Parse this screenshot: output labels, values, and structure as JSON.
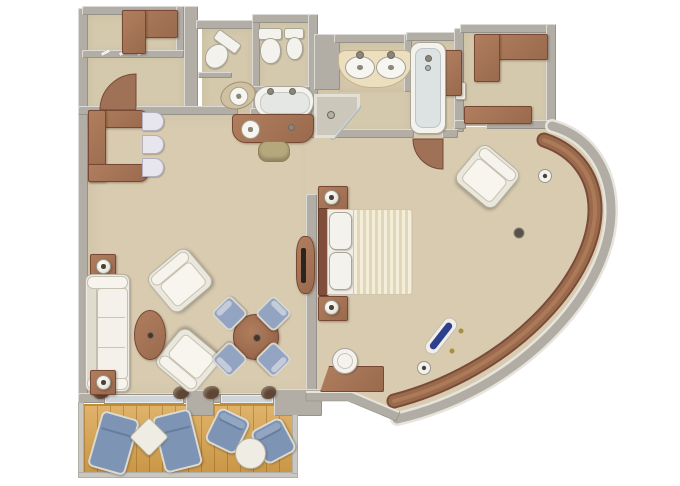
{
  "meta": {
    "kind": "3d-floorplan-rendering",
    "subject": "penthouse-suite-with-curved-veranda",
    "visible_text": []
  },
  "palette": {
    "background": "#ffffff",
    "wall": "#b2aea6",
    "wall_light": "#e7e4dd",
    "wall_dark": "#8f8b83",
    "carpet": "#d8cbb0",
    "bath_floor": "#d5c9ad",
    "teak": "#d9a24a",
    "teak_line": "#a6762a",
    "wood": "#9a6a4e",
    "wood_light": "#b07e5e",
    "wood_dark": "#774834",
    "white_furn": "#efece3",
    "white_furn_border": "#b9b4a6",
    "cream_counter": "#ecdfc0",
    "fixture_white": "#f4f2ec",
    "fixture_line": "#aaa59a",
    "glass": "#cfd5d8",
    "shower_glass": "#e4ebee",
    "blue_deck": "#7e94b4",
    "blue_dining": "#93a3c2",
    "navy": "#2e3f8e",
    "curtain": "#5f4634",
    "duvet_a": "#f3edda",
    "duvet_b": "#e0d6b8",
    "stool": "#b4a87c"
  },
  "rooms": [
    {
      "id": "entry-closet",
      "furniture": [
        "l-shaped-wardrobe"
      ]
    },
    {
      "id": "entry-hall",
      "furniture": [
        "entry-door-swing",
        "closet-door-ticks"
      ]
    },
    {
      "id": "guest-bathroom",
      "furniture": [
        "angled-toilet",
        "pedestal-sink"
      ]
    },
    {
      "id": "master-wc",
      "furniture": [
        "wall-toilet",
        "bidet",
        "whirlpool-tub"
      ]
    },
    {
      "id": "master-bathroom",
      "furniture": [
        "corner-shower",
        "double-sink-vanity",
        "bathtub",
        "side-cabinet",
        "door-swing"
      ]
    },
    {
      "id": "walk-in-closet",
      "furniture": [
        "upper-cabinet-l",
        "lower-cabinet",
        "wall-shelf"
      ]
    },
    {
      "id": "living-room",
      "furniture": [
        "executive-desk",
        "desk-chair",
        "desk-chair",
        "desk-chair",
        "sofa",
        "side-table-lamp",
        "side-table-lamp",
        "armchair",
        "armchair",
        "oval-coffee-table",
        "round-dining-table",
        "dining-chair",
        "dining-chair",
        "dining-chair",
        "dining-chair",
        "vanity-console",
        "vanity-stool",
        "tv-console"
      ]
    },
    {
      "id": "bedroom",
      "furniture": [
        "double-bed-striped-duvet",
        "nightstand-lamp",
        "nightstand-lamp",
        "writing-desk",
        "desk-stool",
        "armchair",
        "curved-window-ledge",
        "ledge-lamp",
        "ledge-lamp",
        "navy-spyglass",
        "dark-knob"
      ]
    },
    {
      "id": "veranda",
      "furniture": [
        "teak-deck",
        "lounger",
        "lounger",
        "square-table",
        "deck-chair",
        "deck-chair",
        "round-table",
        "railing"
      ]
    }
  ]
}
